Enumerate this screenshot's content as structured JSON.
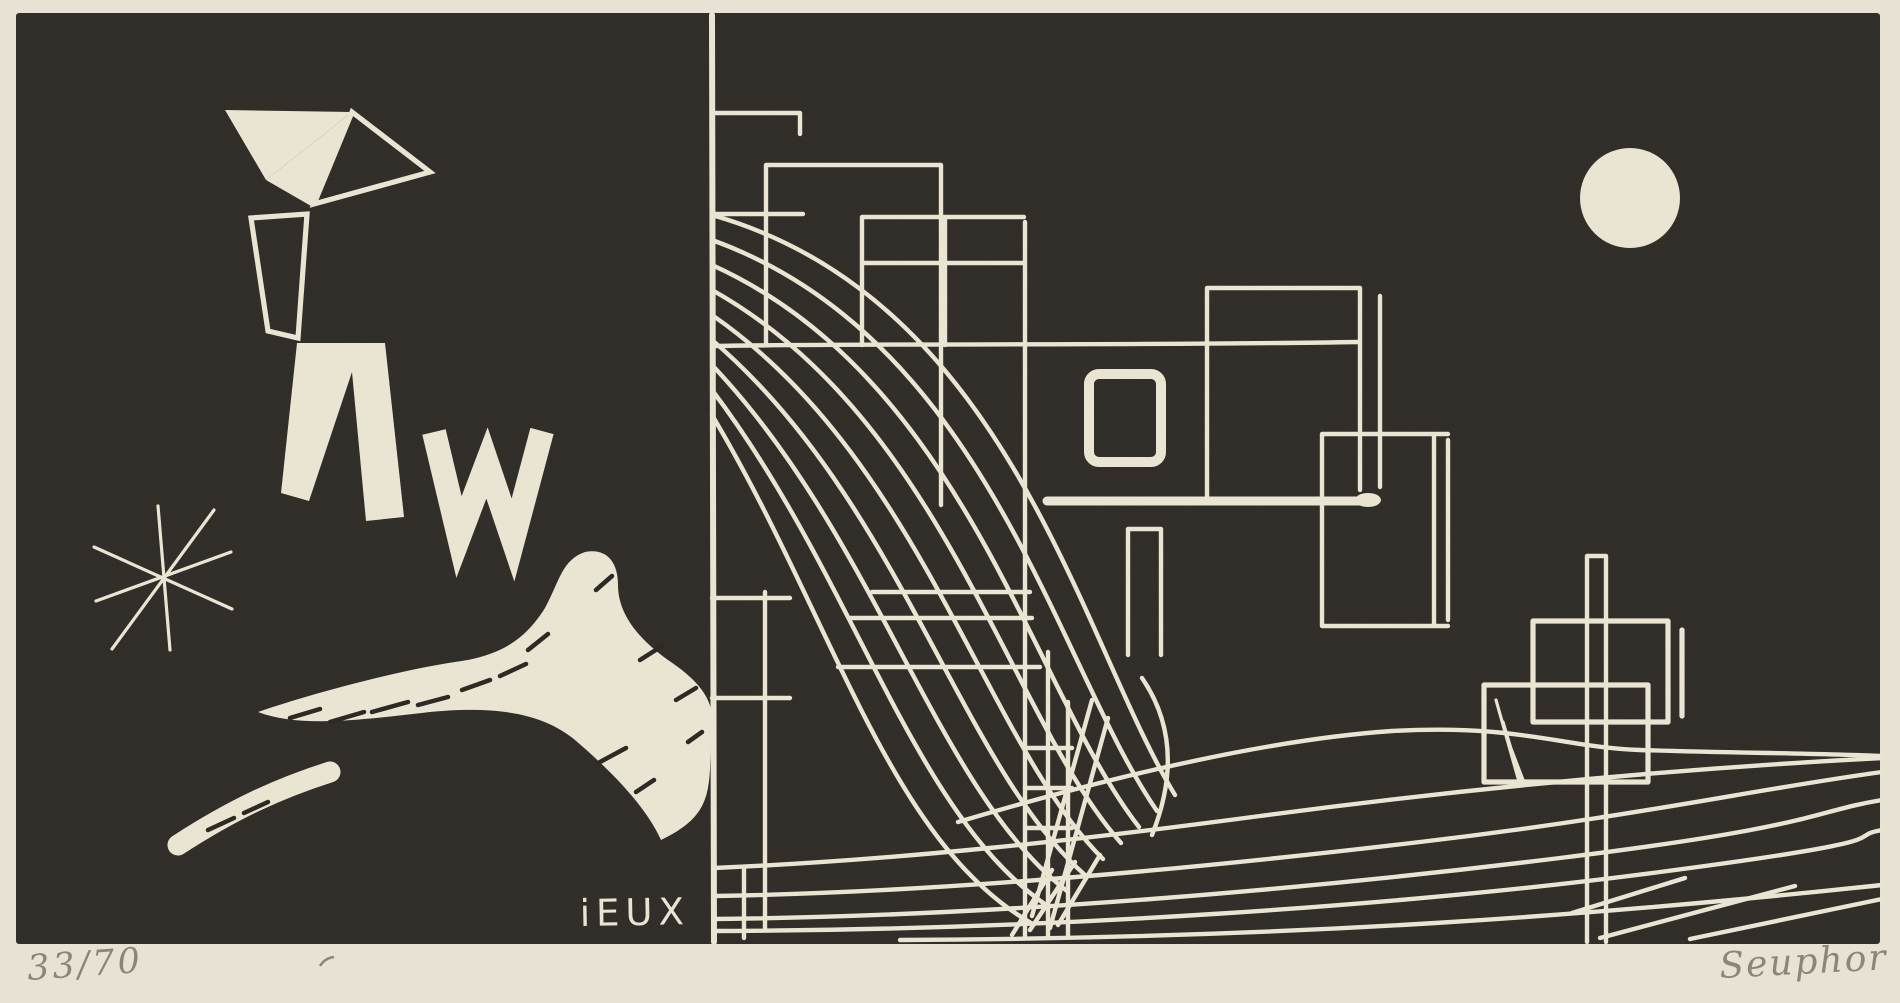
{
  "artwork": {
    "inscription": "iEUX",
    "edition_number": "33/70",
    "signature": "Seuphor"
  },
  "colors": {
    "paper": "#e8e2d4",
    "ink": "#2d2925",
    "cream": "#eae4d2",
    "pencil": "#8d8678"
  }
}
